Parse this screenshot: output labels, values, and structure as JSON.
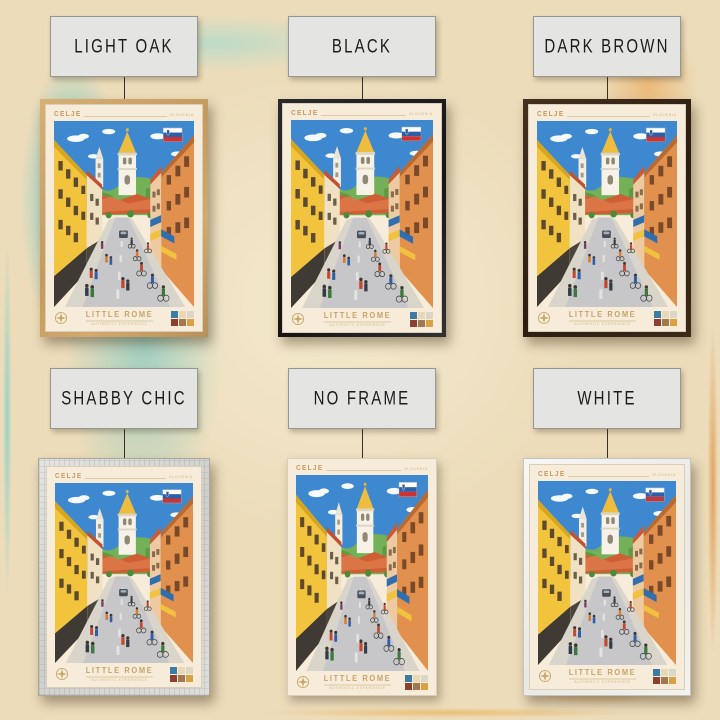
{
  "page": {
    "background_base_color": "#ecdcba",
    "background_teal_accent": "#5cc6c8",
    "background_orange_accent": "#dd8a3a"
  },
  "poster": {
    "title": "CELJE",
    "country": "SLOVENIA",
    "flag": "slovenia-flag",
    "footer_title": "LITTLE ROME",
    "footer_subtitle": "AUTHENTIC EXPERIENCE",
    "palette_swatches": [
      "#3a7ca5",
      "#e7d9b6",
      "#dcd6c6",
      "#8e4030",
      "#a3784e",
      "#d8a243"
    ]
  },
  "variants": [
    {
      "id": "light-oak",
      "label": "LIGHT OAK",
      "frame_color": "#c79e63",
      "row": 0,
      "col": 0
    },
    {
      "id": "black",
      "label": "BLACK",
      "frame_color": "#1c1c1e",
      "row": 0,
      "col": 1
    },
    {
      "id": "dark-brown",
      "label": "DARK BROWN",
      "frame_color": "#35241a",
      "row": 0,
      "col": 2
    },
    {
      "id": "shabby-chic",
      "label": "SHABBY CHIC",
      "frame_color": "#d9d9d5",
      "row": 1,
      "col": 0
    },
    {
      "id": "no-frame",
      "label": "NO FRAME",
      "frame_color": "none",
      "row": 1,
      "col": 1
    },
    {
      "id": "white",
      "label": "WHITE",
      "frame_color": "#f3f3f1",
      "row": 1,
      "col": 2
    }
  ]
}
